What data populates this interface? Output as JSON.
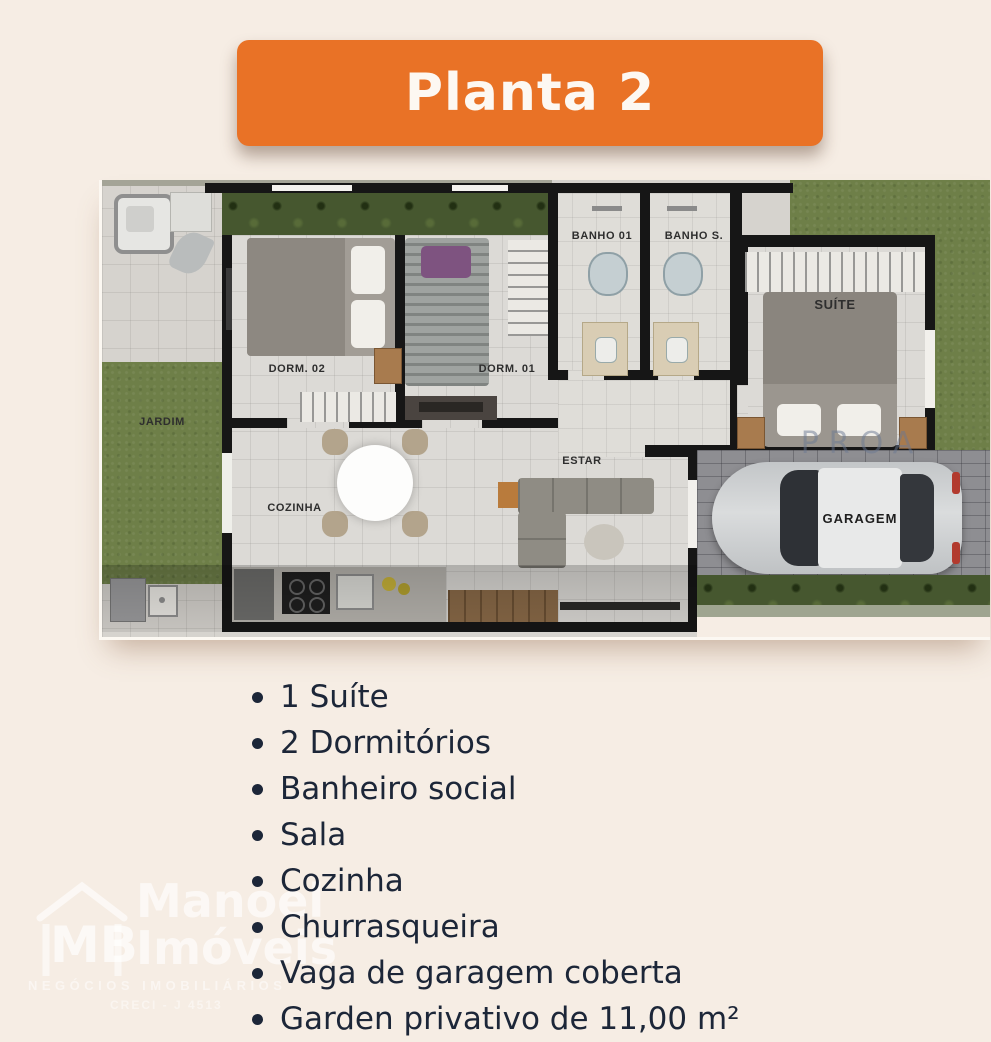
{
  "banner": {
    "label": "Planta 2",
    "bg": "#E97226"
  },
  "plan": {
    "labels": {
      "jardim": "JARDIM",
      "dorm02": "DORM. 02",
      "dorm01": "DORM. 01",
      "banho01": "BANHO 01",
      "banho_s": "BANHO S.",
      "suite": "SUÍTE",
      "cozinha": "COZINHA",
      "estar": "ESTAR",
      "garagem": "GARAGEM"
    },
    "watermark": "PROA"
  },
  "features": {
    "items": [
      "1 Suíte",
      "2 Dormitórios",
      "Banheiro social",
      "Sala",
      "Cozinha",
      "Churrasqueira",
      "Vaga de garagem coberta",
      "Garden privativo de 11,00 m²"
    ]
  },
  "logo": {
    "initials": "MB",
    "name_line1": "Manoel",
    "name_line2": "Imóveis",
    "tagline": "NEGÓCIOS IMOBILIÁRIOS",
    "creci": "CRECI - J 4513"
  },
  "colors": {
    "background": "#F6EDE4",
    "banner_orange": "#E97226",
    "text_navy": "#1C2638",
    "grass_green": "#6E7F48",
    "hedge_green": "#46572F",
    "floor_gray": "#DCDAD6",
    "wall_black": "#161616",
    "paver_gray": "#8E8E92",
    "car_silver": "#CDCFD0"
  }
}
